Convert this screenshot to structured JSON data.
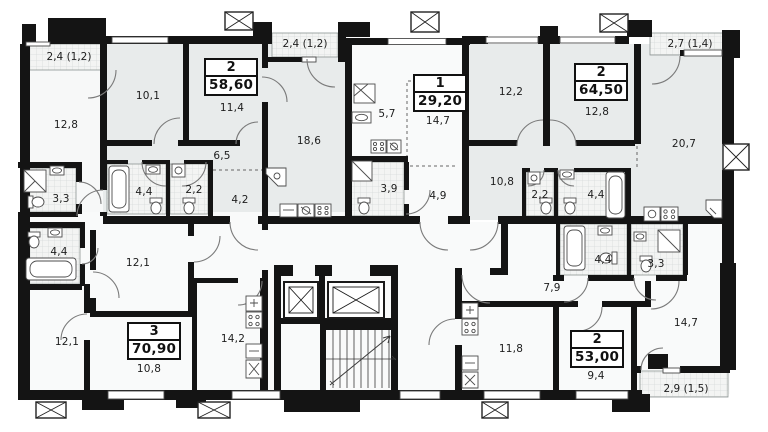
{
  "floor_plan": {
    "apartments": [
      {
        "rooms": "2",
        "area": "58,60"
      },
      {
        "rooms": "1",
        "area": "29,20"
      },
      {
        "rooms": "2",
        "area": "64,50"
      },
      {
        "rooms": "3",
        "area": "70,90"
      },
      {
        "rooms": "2",
        "area": "53,00"
      }
    ],
    "balconies": [
      {
        "label": "2,4 (1,2)"
      },
      {
        "label": "2,4 (1,2)"
      },
      {
        "label": "2,7 (1,4)"
      },
      {
        "label": "2,9 (1,5)"
      }
    ],
    "room_labels": [
      {
        "area": "12,8"
      },
      {
        "area": "10,1"
      },
      {
        "area": "11,4"
      },
      {
        "area": "6,5"
      },
      {
        "area": "4,4"
      },
      {
        "area": "2,2"
      },
      {
        "area": "4,2"
      },
      {
        "area": "18,6"
      },
      {
        "area": "5,7"
      },
      {
        "area": "14,7"
      },
      {
        "area": "3,9"
      },
      {
        "area": "4,9"
      },
      {
        "area": "12,2"
      },
      {
        "area": "12,8"
      },
      {
        "area": "10,8"
      },
      {
        "area": "2,2"
      },
      {
        "area": "4,4"
      },
      {
        "area": "20,7"
      },
      {
        "area": "3,3"
      },
      {
        "area": "4,4"
      },
      {
        "area": "12,1"
      },
      {
        "area": "12,1"
      },
      {
        "area": "10,8"
      },
      {
        "area": "14,2"
      },
      {
        "area": "7,9"
      },
      {
        "area": "4,4"
      },
      {
        "area": "3,3"
      },
      {
        "area": "11,8"
      },
      {
        "area": "9,4"
      },
      {
        "area": "14,7"
      }
    ]
  }
}
